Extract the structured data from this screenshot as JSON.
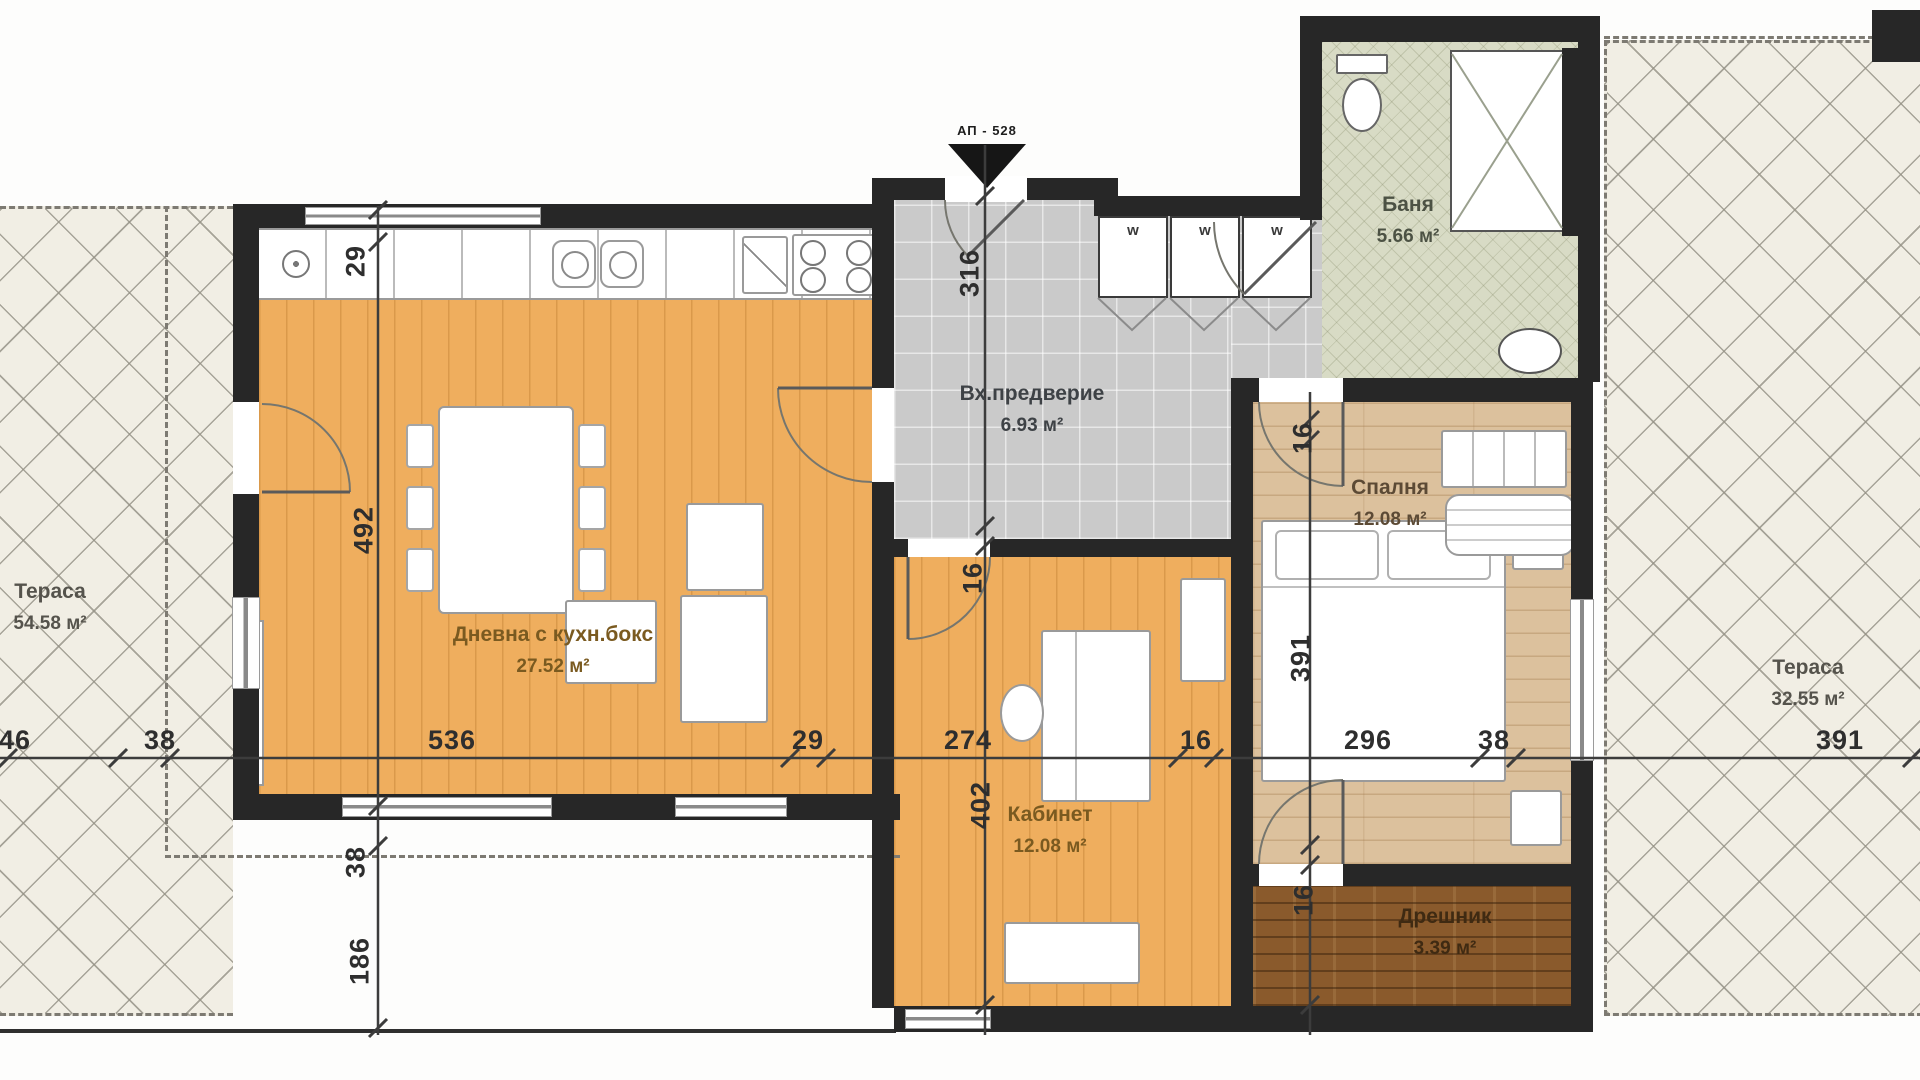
{
  "plan": {
    "apartment_label": "АП - 528",
    "rooms": {
      "terrace_left": {
        "name": "Тераса",
        "area": "54.58 м²"
      },
      "living": {
        "name": "Дневна с кухн.бокс",
        "area": "27.52 м²"
      },
      "vestibule": {
        "name": "Вх.предверие",
        "area": "6.93 м²"
      },
      "bath": {
        "name": "Баня",
        "area": "5.66 м²"
      },
      "bedroom": {
        "name": "Спалня",
        "area": "12.08 м²"
      },
      "office": {
        "name": "Кабинет",
        "area": "12.08 м²"
      },
      "closet": {
        "name": "Дрешник",
        "area": "3.39 м²"
      },
      "terrace_right": {
        "name": "Тераса",
        "area": "32.55 м²"
      }
    },
    "wardrobe_labels": [
      "w",
      "w",
      "w"
    ],
    "dimensions": {
      "horizontal": [
        "46",
        "38",
        "536",
        "29",
        "274",
        "16",
        "296",
        "38",
        "391"
      ],
      "vertical_left": [
        "29",
        "492",
        "38",
        "186"
      ],
      "vertical_center": [
        "316",
        "16",
        "402"
      ],
      "vertical_right": [
        "16",
        "391",
        "16"
      ]
    },
    "colors": {
      "wall": "#272727",
      "living_floor": "#efae5e",
      "bedroom_floor": "#dcc19d",
      "closet_floor": "#8a5a2c",
      "vestibule_floor": "#cacaca",
      "bath_floor": "#d8dbc5",
      "terrace": "#f1eee4"
    }
  }
}
